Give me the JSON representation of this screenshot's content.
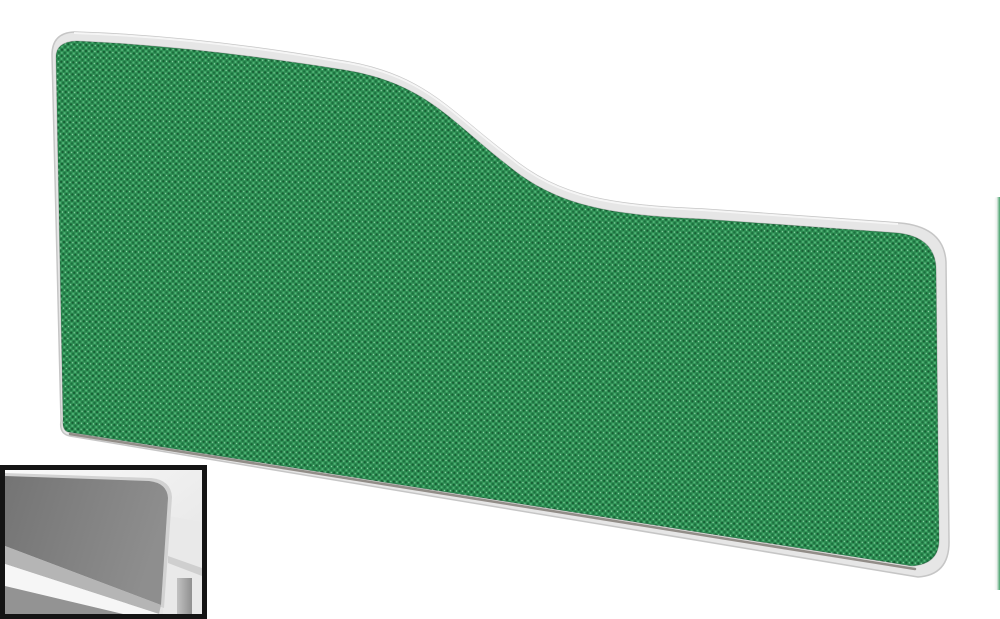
{
  "page": {
    "background": "#ffffff"
  },
  "product_photo": {
    "fabric_colors": {
      "base": "#2e9054",
      "weave_dark": "#1c6e3e",
      "weave_darker": "#175f35",
      "weave_light": "#57b87c",
      "weave_speckle": "#8fd6a9"
    },
    "trim_colors": {
      "fill": "#e6e6e6",
      "edge": "#c6c6c6",
      "highlight": "#f7f7f7"
    }
  },
  "inset_thumbnail": {
    "border_color": "#141414",
    "greyscale_colors": {
      "background_light": "#fafafa",
      "background_dark": "#e2e2e2",
      "screen_panel_dark": "#747474",
      "screen_panel_light": "#8e8e8e",
      "screen_trim": "#d2d2d2",
      "lower_band": "#b5b5b5",
      "desktop_white": "#f6f6f6",
      "bottom_strip": "#939393",
      "desk_surface": "#e9e9e9",
      "desk_leg": "#8f8f8f"
    }
  },
  "adjacent_image_sliver": {
    "grey": "#eef1ef",
    "green": "#44a06a"
  },
  "colors": {
    "page-bg": "#ffffff",
    "fabric-base": "#2e9054",
    "fabric-dark": "#1c6e3e",
    "fabric-darker": "#175f35",
    "fabric-light": "#57b87c",
    "fabric-speckle": "#8fd6a9",
    "trim-fill": "#e6e6e6",
    "trim-edge": "#c6c6c6",
    "trim-highlight": "#f7f7f7",
    "inset-border": "#141414",
    "inset-bg-1": "#fafafa",
    "inset-bg-2": "#e2e2e2",
    "inset-panel-dark-1": "#747474",
    "inset-panel-dark-2": "#8e8e8e",
    "inset-panel-trim": "#d2d2d2",
    "inset-band": "#b5b5b5",
    "inset-white-stripe": "#f6f6f6",
    "inset-bottom-strip": "#939393",
    "inset-desk": "#e9e9e9",
    "inset-desk-edge": "#cfcfcf",
    "inset-leg-1": "#c2c2c2",
    "inset-leg-2": "#8f8f8f",
    "sliver-grey": "#eef1ef",
    "sliver-green": "#44a06a"
  }
}
